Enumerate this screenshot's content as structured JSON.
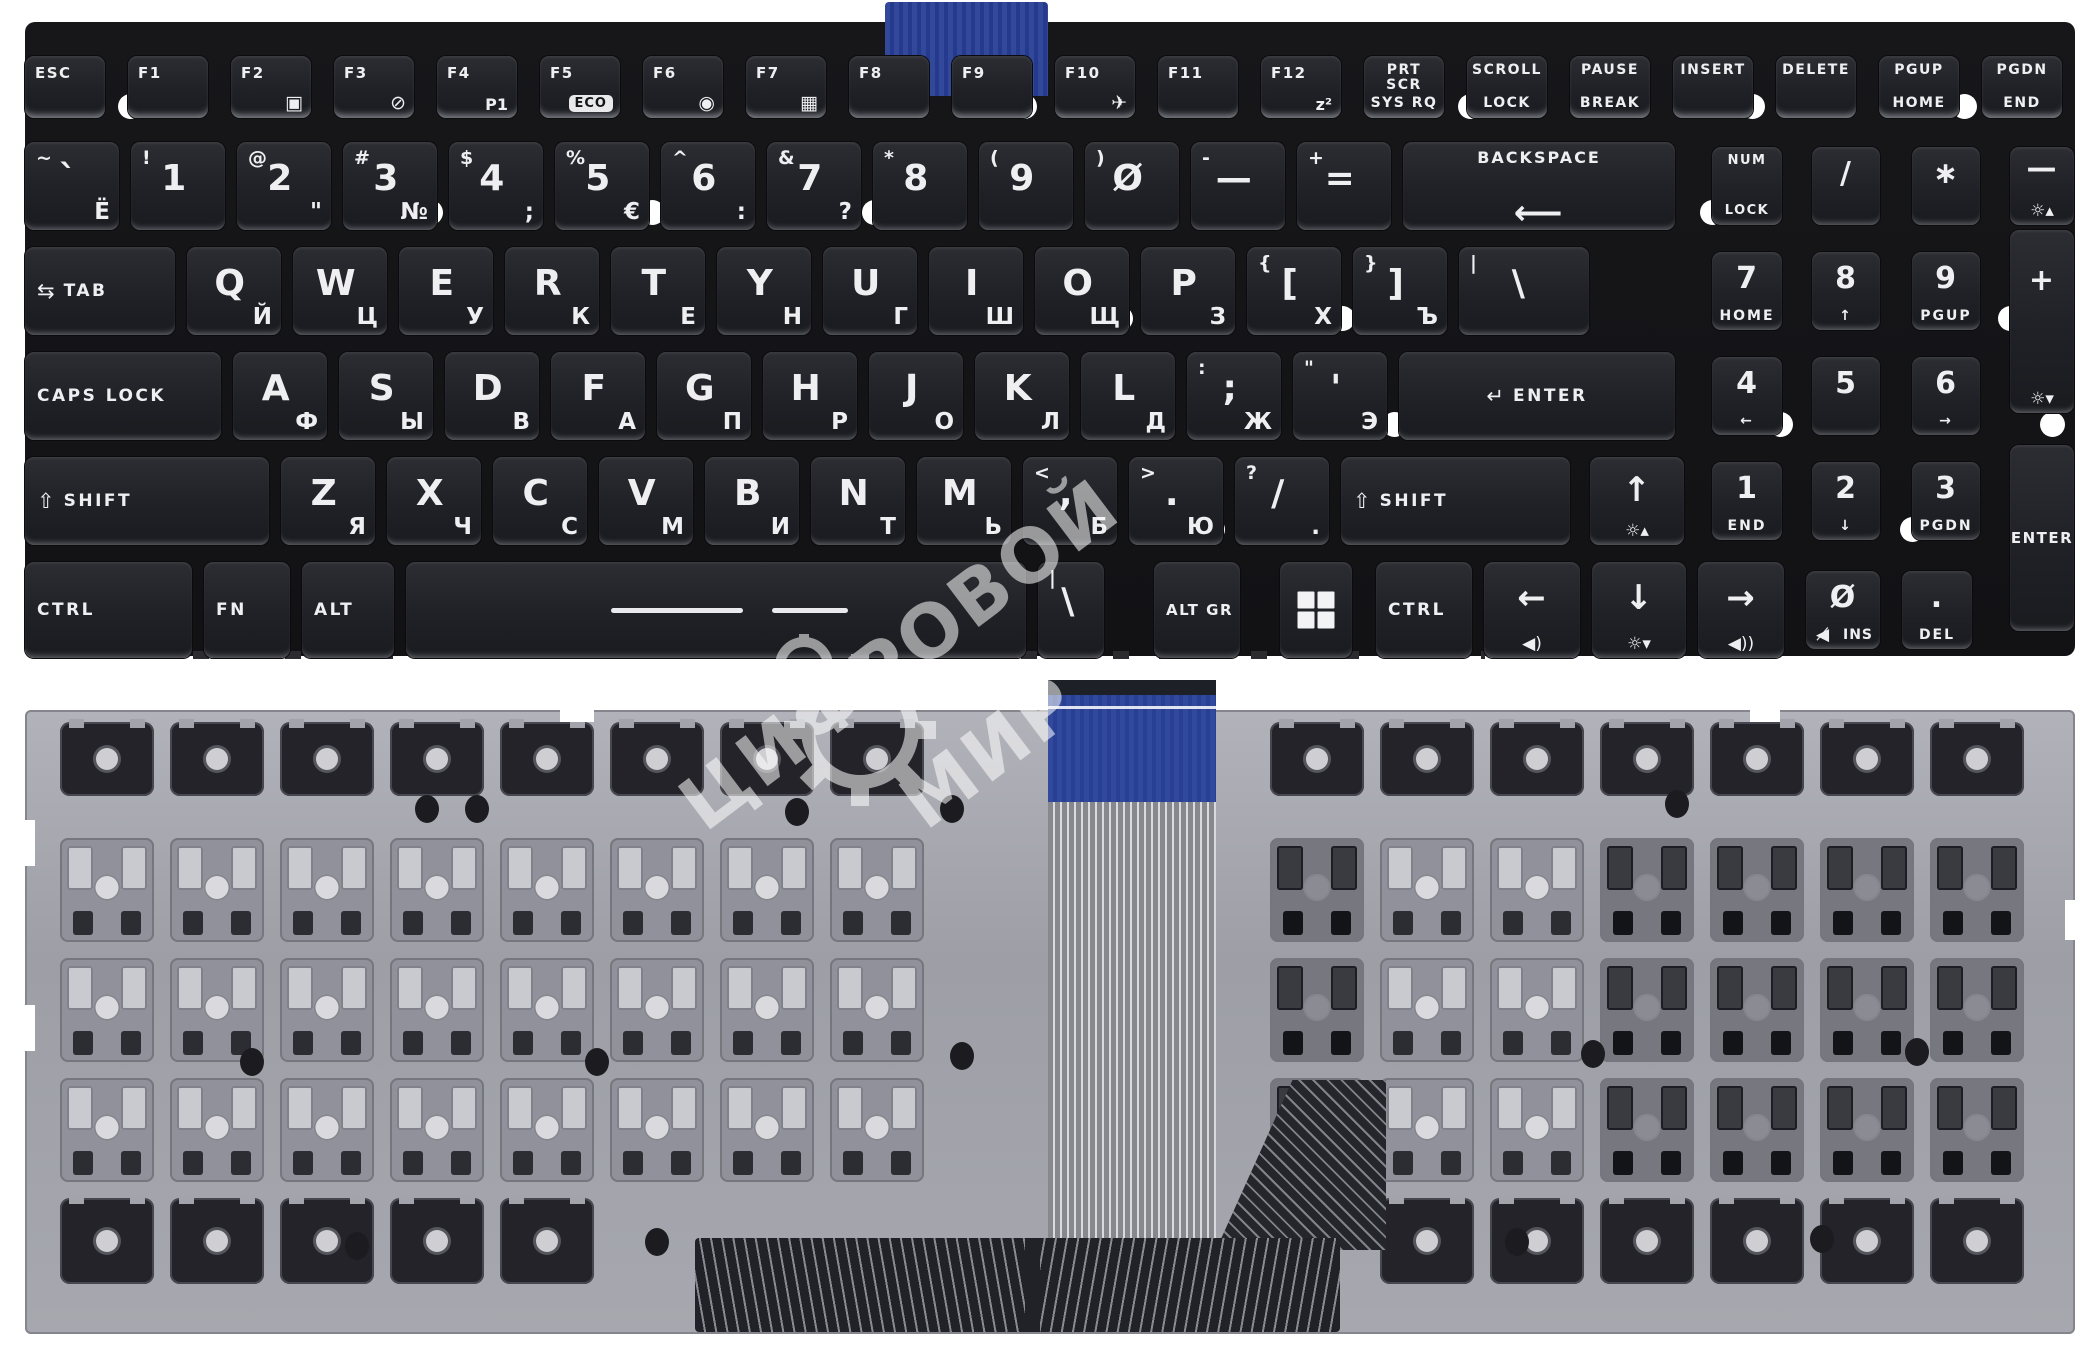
{
  "product": {
    "description": "Laptop keyboard, black keys with Russian/English legends, front side above and metal backplate with blue ribbon cable below"
  },
  "watermark": {
    "line1": "ЦИФРОВОЙ",
    "line2": "МИР"
  },
  "colors": {
    "background": "#ffffff",
    "key_bg": "#232428",
    "panel_bg": "#141418",
    "legend": "#efeff1",
    "backplate": "#a2a3ab",
    "ribbon_blue": "#31499c",
    "membrane_dark": "#202227"
  },
  "icons": {
    "tab-arrows-icon": "⇆",
    "shift-arrow-icon": "⇧",
    "enter-arrow-icon": "↵",
    "displays-icon": "▣",
    "touchpad-off-icon": "⊘",
    "webcam-icon": "◉",
    "gearbox-icon": "▦",
    "airplane-icon": "✈",
    "backlight-up-icon": "☼▴",
    "backlight-down-icon": "☼▾",
    "volume-down-icon": "◀)",
    "volume-up-icon": "◀))",
    "mute-icon": "◀̸",
    "eco-label": "ECO"
  },
  "keyboard": {
    "rows": [
      {
        "name": "function-row",
        "cls": "rowf",
        "y": 34,
        "h": 62,
        "gap": 23,
        "w": 80,
        "keys": [
          {
            "id": "esc",
            "text": "ESC"
          },
          {
            "id": "f1",
            "text": "F1"
          },
          {
            "id": "f2",
            "text": "F2",
            "icon": "displays-icon"
          },
          {
            "id": "f3",
            "text": "F3",
            "icon": "touchpad-off-icon"
          },
          {
            "id": "f4",
            "text": "F4",
            "sub": "P1"
          },
          {
            "id": "f5",
            "text": "F5",
            "kind": "eco"
          },
          {
            "id": "f6",
            "text": "F6",
            "icon": "webcam-icon"
          },
          {
            "id": "f7",
            "text": "F7",
            "icon": "gearbox-icon"
          },
          {
            "id": "f8",
            "text": "F8"
          },
          {
            "id": "f9",
            "text": "F9"
          },
          {
            "id": "f10",
            "text": "F10",
            "icon": "airplane-icon"
          },
          {
            "id": "f11",
            "text": "F11"
          },
          {
            "id": "f12",
            "text": "F12",
            "sub": "z²"
          },
          {
            "id": "prtscr",
            "lines": [
              "PRT SCR",
              "SYS RQ"
            ]
          },
          {
            "id": "scroll-lock",
            "lines": [
              "SCROLL",
              "LOCK"
            ]
          },
          {
            "id": "pause",
            "lines": [
              "PAUSE",
              "BREAK"
            ]
          },
          {
            "id": "insert",
            "lines": [
              "INSERT"
            ]
          },
          {
            "id": "delete",
            "lines": [
              "DELETE"
            ]
          },
          {
            "id": "pgup",
            "lines": [
              "PGUP",
              "HOME"
            ]
          },
          {
            "id": "pgdn",
            "lines": [
              "PGDN",
              "END"
            ]
          }
        ]
      },
      {
        "name": "number-row",
        "y": 120,
        "h": 88,
        "gap": 12,
        "w": 94,
        "keys": [
          {
            "id": "grave",
            "shift": "~",
            "main": "`",
            "sub": "Ё"
          },
          {
            "id": "1",
            "shift": "!",
            "main": "1"
          },
          {
            "id": "2",
            "shift": "@",
            "main": "2",
            "sub": "\""
          },
          {
            "id": "3",
            "shift": "#",
            "main": "3",
            "sub": "№"
          },
          {
            "id": "4",
            "shift": "$",
            "main": "4",
            "sub": ";"
          },
          {
            "id": "5",
            "shift": "%",
            "main": "5",
            "sub": "€"
          },
          {
            "id": "6",
            "shift": "^",
            "main": "6",
            "sub": ":"
          },
          {
            "id": "7",
            "shift": "&",
            "main": "7",
            "sub": "?"
          },
          {
            "id": "8",
            "shift": "*",
            "main": "8"
          },
          {
            "id": "9",
            "shift": "(",
            "main": "9"
          },
          {
            "id": "0",
            "shift": ")",
            "main": "Ø"
          },
          {
            "id": "minus",
            "shift": "-",
            "main": "—"
          },
          {
            "id": "equals",
            "shift": "+",
            "main": "="
          },
          {
            "id": "backspace",
            "lines": [
              "BACKSPACE",
              "⟵"
            ],
            "w": 272
          },
          {
            "id": "numlock",
            "lines": [
              "NUM",
              "LOCK"
            ],
            "w": 70,
            "ml": 25,
            "cls": "np small"
          },
          {
            "id": "np-divide",
            "main": "/",
            "w": 68,
            "ml": 18,
            "cls": "np"
          },
          {
            "id": "np-multiply",
            "main": "∗",
            "w": 68,
            "ml": 20,
            "cls": "np"
          },
          {
            "id": "np-minus",
            "main": "—",
            "icon": "backlight-up-icon",
            "w": 64,
            "ml": 18,
            "cls": "np npn"
          }
        ]
      },
      {
        "name": "tab-row",
        "y": 225,
        "h": 88,
        "gap": 12,
        "w": 94,
        "keys": [
          {
            "id": "tab",
            "pre": "tab-arrows-icon",
            "text": "TAB",
            "w": 150
          },
          {
            "id": "q",
            "main": "Q",
            "sub": "Й"
          },
          {
            "id": "w",
            "main": "W",
            "sub": "Ц"
          },
          {
            "id": "e",
            "main": "E",
            "sub": "У"
          },
          {
            "id": "r",
            "main": "R",
            "sub": "К"
          },
          {
            "id": "t",
            "main": "T",
            "sub": "Е"
          },
          {
            "id": "y",
            "main": "Y",
            "sub": "Н"
          },
          {
            "id": "u",
            "main": "U",
            "sub": "Г"
          },
          {
            "id": "i",
            "main": "I",
            "sub": "Ш"
          },
          {
            "id": "o",
            "main": "O",
            "sub": "Щ"
          },
          {
            "id": "p",
            "main": "P",
            "sub": "З"
          },
          {
            "id": "lbracket",
            "shift": "{",
            "main": "[",
            "sub": "Х"
          },
          {
            "id": "rbracket",
            "shift": "}",
            "main": "]",
            "sub": "Ъ"
          },
          {
            "id": "backslash",
            "shift": "|",
            "main": "\\",
            "w": 130
          },
          {
            "id": "np7",
            "main": "7",
            "sub2": "HOME",
            "w": 70,
            "ml": 111,
            "cls": "np"
          },
          {
            "id": "np8",
            "main": "8",
            "sub2": "↑",
            "w": 68,
            "ml": 18,
            "cls": "np"
          },
          {
            "id": "np9",
            "main": "9",
            "sub2": "PGUP",
            "w": 68,
            "ml": 20,
            "cls": "np"
          }
        ]
      },
      {
        "name": "caps-row",
        "y": 330,
        "h": 88,
        "gap": 12,
        "w": 94,
        "keys": [
          {
            "id": "capslock",
            "text": "CAPS LOCK",
            "w": 196
          },
          {
            "id": "a",
            "main": "A",
            "sub": "Ф"
          },
          {
            "id": "s",
            "main": "S",
            "sub": "Ы"
          },
          {
            "id": "d",
            "main": "D",
            "sub": "В"
          },
          {
            "id": "f",
            "main": "F",
            "sub": "А"
          },
          {
            "id": "g",
            "main": "G",
            "sub": "П"
          },
          {
            "id": "h",
            "main": "H",
            "sub": "Р"
          },
          {
            "id": "j",
            "main": "J",
            "sub": "О"
          },
          {
            "id": "k",
            "main": "K",
            "sub": "Л"
          },
          {
            "id": "l",
            "main": "L",
            "sub": "Д"
          },
          {
            "id": "semicolon",
            "shift": ":",
            "main": ";",
            "sub": "Ж"
          },
          {
            "id": "quote",
            "shift": "\"",
            "main": "'",
            "sub": "Э"
          },
          {
            "id": "enter",
            "pre": "enter-arrow-icon",
            "text": "ENTER",
            "w": 276,
            "cls": "centered"
          },
          {
            "id": "np4",
            "main": "4",
            "sub2": "←",
            "w": 70,
            "ml": 25,
            "cls": "np"
          },
          {
            "id": "np5",
            "main": "5",
            "w": 68,
            "ml": 18,
            "cls": "np"
          },
          {
            "id": "np6",
            "main": "6",
            "sub2": "→",
            "w": 68,
            "ml": 20,
            "cls": "np"
          }
        ]
      },
      {
        "name": "shift-row",
        "y": 435,
        "h": 88,
        "gap": 12,
        "w": 94,
        "keys": [
          {
            "id": "shift-left",
            "pre": "shift-arrow-icon",
            "text": "SHIFT",
            "w": 244
          },
          {
            "id": "z",
            "main": "Z",
            "sub": "Я"
          },
          {
            "id": "x",
            "main": "X",
            "sub": "Ч"
          },
          {
            "id": "c",
            "main": "C",
            "sub": "С"
          },
          {
            "id": "v",
            "main": "V",
            "sub": "М"
          },
          {
            "id": "b",
            "main": "B",
            "sub": "И"
          },
          {
            "id": "n",
            "main": "N",
            "sub": "Т"
          },
          {
            "id": "m",
            "main": "M",
            "sub": "Ь"
          },
          {
            "id": "comma",
            "shift": "<",
            "main": ",",
            "sub": "Б"
          },
          {
            "id": "period",
            "shift": ">",
            "main": ".",
            "sub": "Ю"
          },
          {
            "id": "slash",
            "shift": "?",
            "main": "/",
            "sub": "."
          },
          {
            "id": "shift-right",
            "pre": "shift-arrow-icon",
            "text": "SHIFT",
            "w": 229
          },
          {
            "id": "arrow-up",
            "main": "↑",
            "icon": "backlight-up-icon",
            "w": 94,
            "ml": 8,
            "cls": "arrow"
          },
          {
            "id": "np1",
            "main": "1",
            "sub2": "END",
            "w": 70,
            "ml": 16,
            "cls": "np"
          },
          {
            "id": "np2",
            "main": "2",
            "sub2": "↓",
            "w": 68,
            "ml": 18,
            "cls": "np"
          },
          {
            "id": "np3",
            "main": "3",
            "sub2": "PGDN",
            "w": 68,
            "ml": 20,
            "cls": "np"
          }
        ]
      },
      {
        "name": "bottom-row",
        "y": 540,
        "h": 96,
        "gap": 12,
        "w": 94,
        "keys": [
          {
            "id": "ctrl-left",
            "text": "CTRL",
            "w": 167
          },
          {
            "id": "fn",
            "text": "FN",
            "w": 86
          },
          {
            "id": "alt",
            "text": "ALT",
            "w": 92
          },
          {
            "id": "space",
            "kind": "space",
            "w": 620
          },
          {
            "id": "backslash2",
            "shift": "|",
            "main": "\\",
            "w": 66
          },
          {
            "id": "altgr",
            "text": "ALT GR",
            "w": 86,
            "ml": 38,
            "cls": "small"
          },
          {
            "id": "win",
            "kind": "win",
            "w": 72,
            "ml": 28
          },
          {
            "id": "ctrl-right",
            "text": "CTRL",
            "w": 96,
            "ml": 12
          },
          {
            "id": "arrow-left",
            "main": "←",
            "icon": "volume-down-icon",
            "w": 96,
            "cls": "arrow"
          },
          {
            "id": "arrow-down",
            "main": "↓",
            "icon": "backlight-down-icon",
            "w": 94,
            "cls": "arrow"
          },
          {
            "id": "arrow-right",
            "main": "→",
            "icon": "volume-up-icon",
            "w": 86,
            "cls": "arrow"
          },
          {
            "id": "np0",
            "main": "Ø",
            "icon": "mute-icon",
            "sub2": "INS",
            "w": 74,
            "ml": 10,
            "cls": "np ins"
          },
          {
            "id": "np-dot",
            "main": ".",
            "sub2": "DEL",
            "w": 70,
            "ml": 10,
            "cls": "np"
          }
        ]
      }
    ],
    "abs_keys": [
      {
        "id": "np-plus",
        "main": "+",
        "icon": "backlight-down-icon",
        "x": 2010,
        "y": 230,
        "w": 64,
        "h": 183,
        "cls": "np npn"
      },
      {
        "id": "np-enter",
        "text": "ENTER",
        "x": 2010,
        "y": 445,
        "w": 64,
        "h": 186,
        "cls": "centered small"
      }
    ]
  }
}
